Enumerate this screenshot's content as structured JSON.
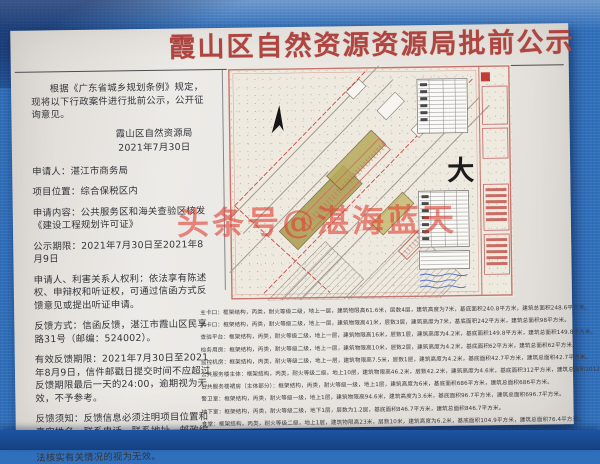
{
  "title": "霞山区自然资源资源局批前公示",
  "watermark": "头条号@湛海蓝天",
  "left_column": {
    "intro": "根据《广东省城乡规划条例》规定，现将以下行政案件进行批前公示，公开征询意见。",
    "agency": "霞山区自然资源局",
    "date": "2021年7月30日",
    "items": [
      "申请人：湛江市商务局",
      "项目位置：综合保税区内",
      "申请内容：公共服务区和海关查验区核发《建设工程规划许可证》",
      "公示期限：2021年7月30日至2021年8月9日",
      "申请人、利害关系人权利：依法享有陈述权、申辩权和听证权，可通过信函方式反馈意见或提出听证申请。",
      "反馈方式：信函反馈，湛江市霞山区民享路31号（邮编：524002）。",
      "有效反馈期限：2021年7月30日至2021年8月9日，信件邮戳日提交时间不应超过反馈期限最后一天的24:00，逾期视为无效，不予参考。",
      "反馈须知：反馈信息必须注明项目位置和真实姓名、联系电话、联系地址、邮政编码，如反馈信息不准确或不完整，导致无法核实有关情况的视为无效。"
    ]
  },
  "map": {
    "big_label": "大"
  },
  "building_specs": [
    "主卡口：框架结构，丙类，耐火等级二级，地上一层，建筑物限高61.6米，层数4层，建筑高度为7米，基底面积240.8平方米，建筑总面积248.6平方米。",
    "内卡口：框架结构，丙类，耐火等级二级，地上一层，建筑物限高41米，层数3层，建筑高度为7米，基底面积242平方米，建筑总面积98平方米。",
    "查验平台：框架结构，丙类，耐火等级二级，地上一层，建筑物限高16米，层数1层，建筑高度为4.2米，基底面积149.8平方米，建筑总面积149.8平方米。",
    "检务用房：框架结构，丙类，耐火等级二级，地上一层，建筑物限高10米，层数2层，建筑高度为4.2米，基底面积62平方米，建筑总面积62平方米。",
    "监控机房：框架结构，丙类，耐火等级二级，地上一层，建筑物限高7.5米，层数1层，建筑高度为4.2米，基底面积42.7平方米，建筑总面积42.7平方米。",
    "公共服务楼主体：框架结构，丙类，耐火等级二级，地上10层，建筑物限高46.2米，层数42.2米，建筑高度为4.6米，基底面积312平方米，建筑总面积1012.4平方米。",
    "公共服务楼裙房（主体部分）：框架结构，丙类，耐火等级一级，地上1层，建筑高度为6米，基底面积686平方米，建筑总面积686平方米。",
    "警卫室：框架结构，丙类，耐火等级一级，地上1层，建筑物限高94.6米，建筑高度为3.6米，基底面积96.7平方米，建筑总面积696.7平方米。",
    "地下室：框架结构，丙类，耐火等级二级，地下1层，层数为1.2层，基底面积846.7平方米，建筑总面积846.7平方米。",
    "食堂：框架结构，丙类，耐火等级二级，地上1层，建筑物限高23米，层数10米，建筑高度为6.2米，基底面积104.9平方米，建筑总面积76.4平方米。"
  ],
  "colors": {
    "tarp_blue": "#2f6fbb",
    "tarp_dark_band": "#16407f",
    "paper": "#e9e6e1",
    "title_red": "#b04540",
    "watermark_red": "#df3e30",
    "map_frame_pink": "#c4766e",
    "building_olive": "#aa9c4f",
    "annotation_blue": "#3a5cc0"
  }
}
